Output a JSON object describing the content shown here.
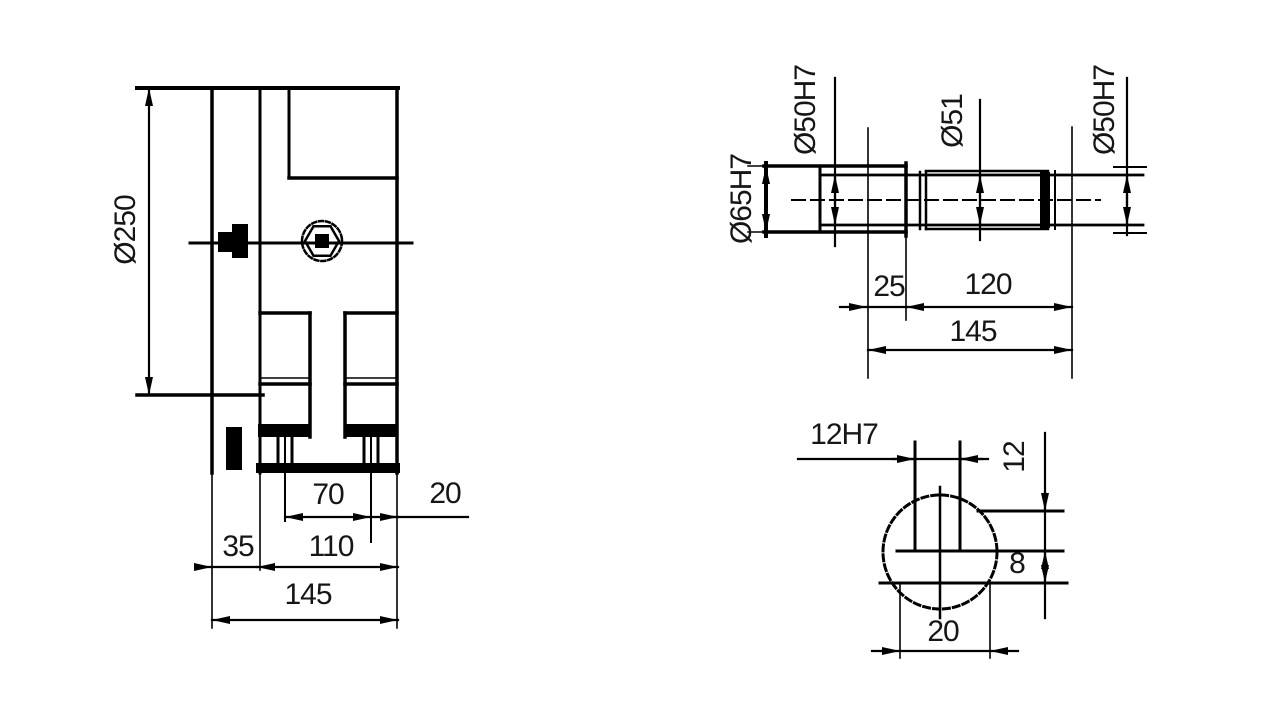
{
  "page": {
    "background": "#ffffff",
    "ink": "#000000",
    "kind": "engineering drawing, three orthographic views of a gearbox housing"
  },
  "front_view": {
    "bore_diameter": "Ø250",
    "foot_span": "70",
    "edge_offset": "20",
    "step_width": "35",
    "inner_width": "110",
    "overall_width": "145"
  },
  "top_view": {
    "left_face_bore": "Ø65H7",
    "left_bearing_bore": "Ø50H7",
    "middle_bore": "Ø51",
    "right_bearing_bore": "Ø50H7",
    "offset": "25",
    "bearing_centers": "120",
    "overall_length": "145"
  },
  "section_view": {
    "keyway_width": "12H7",
    "keyway_dim_vertical": "12",
    "keyway_depth": "8",
    "slot_width": "20"
  }
}
